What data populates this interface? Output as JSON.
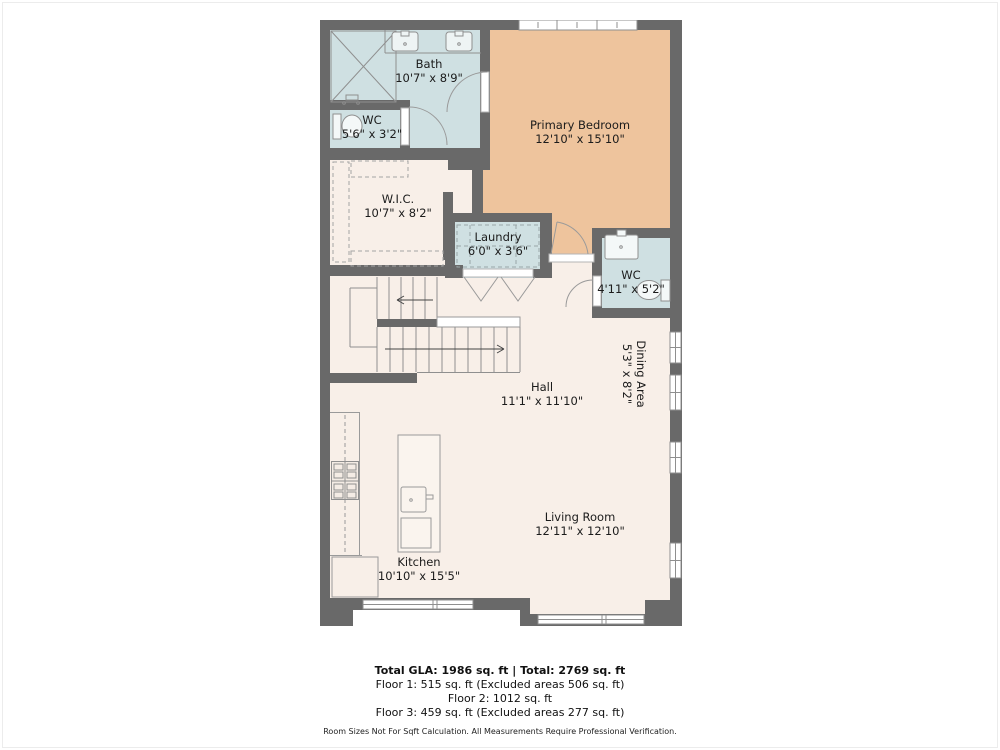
{
  "plan": {
    "rooms": [
      {
        "name": "Bath",
        "dims": "10'7\" x 8'9\""
      },
      {
        "name": "WC",
        "dims": "5'6\" x 3'2\""
      },
      {
        "name": "Primary Bedroom",
        "dims": "12'10\" x 15'10\""
      },
      {
        "name": "W.I.C.",
        "dims": "10'7\" x 8'2\""
      },
      {
        "name": "Laundry",
        "dims": "6'0\" x 3'6\""
      },
      {
        "name": "WC",
        "dims": "4'11\" x 5'2\""
      },
      {
        "name": "Hall",
        "dims": "11'1\" x 11'10\""
      },
      {
        "name": "Dining Area",
        "dims": "5'3\" x 8'2\""
      },
      {
        "name": "Kitchen",
        "dims": "10'10\" x 15'5\""
      },
      {
        "name": "Living Room",
        "dims": "12'11\" x 12'10\""
      }
    ],
    "summary": {
      "total_line": "Total GLA: 1986 sq. ft | Total: 2769 sq. ft",
      "floor1": "Floor 1: 515 sq. ft (Excluded areas 506 sq. ft)",
      "floor2": "Floor 2: 1012 sq. ft",
      "floor3": "Floor 3: 459 sq. ft (Excluded areas 277 sq. ft)",
      "disclaimer": "Room Sizes Not For Sqft Calculation. All Measurements Require Professional Verification."
    },
    "colors": {
      "wall": "#696969",
      "wet_room": "#cfe0e2",
      "bedroom": "#eec49d",
      "floor": "#f8efe8"
    }
  }
}
